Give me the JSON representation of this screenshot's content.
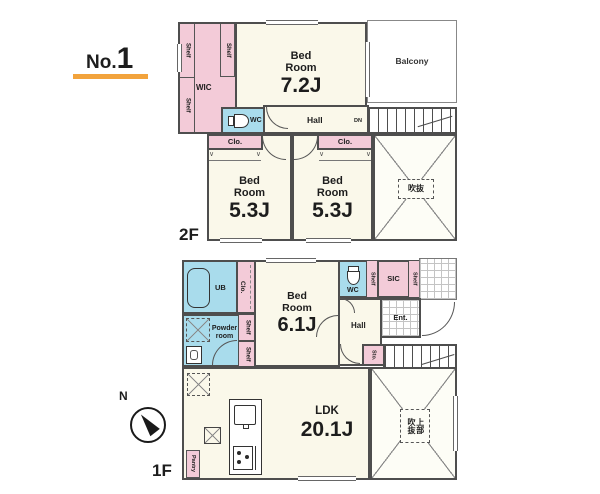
{
  "header": {
    "no_prefix": "No.",
    "no_value": "1"
  },
  "floors": {
    "f2": "2F",
    "f1": "1F"
  },
  "compass": {
    "north": "N"
  },
  "labels": {
    "shelf": "Shelf",
    "wic": "WIC",
    "wc": "WC",
    "hall": "Hall",
    "clo": "Clo.",
    "dn": "DN",
    "up": "UP",
    "balcony": "Balcony",
    "ub": "UB",
    "powder_line1": "Powder",
    "powder_line2": "room",
    "sic": "SIC",
    "ent": "Ent.",
    "sto": "Sto.",
    "pantry": "Pantry",
    "bed_line1": "Bed",
    "bed_line2": "Room",
    "ldk": "LDK",
    "void_2f": "吹抜",
    "void_1f_line1": "上部",
    "void_1f_line2": "吹抜"
  },
  "rooms": {
    "bedroom_2f_main_size": "7.2J",
    "bedroom_2f_left_size": "5.3J",
    "bedroom_2f_right_size": "5.3J",
    "bedroom_1f_size": "6.1J",
    "ldk_size": "20.1J"
  },
  "colors": {
    "closet_pink": "#f3cbd8",
    "wet_blue": "#a9dcec",
    "room_cream": "#faf8ea",
    "wall_gray": "#4e4e4e",
    "accent_orange": "#f2a33c"
  }
}
